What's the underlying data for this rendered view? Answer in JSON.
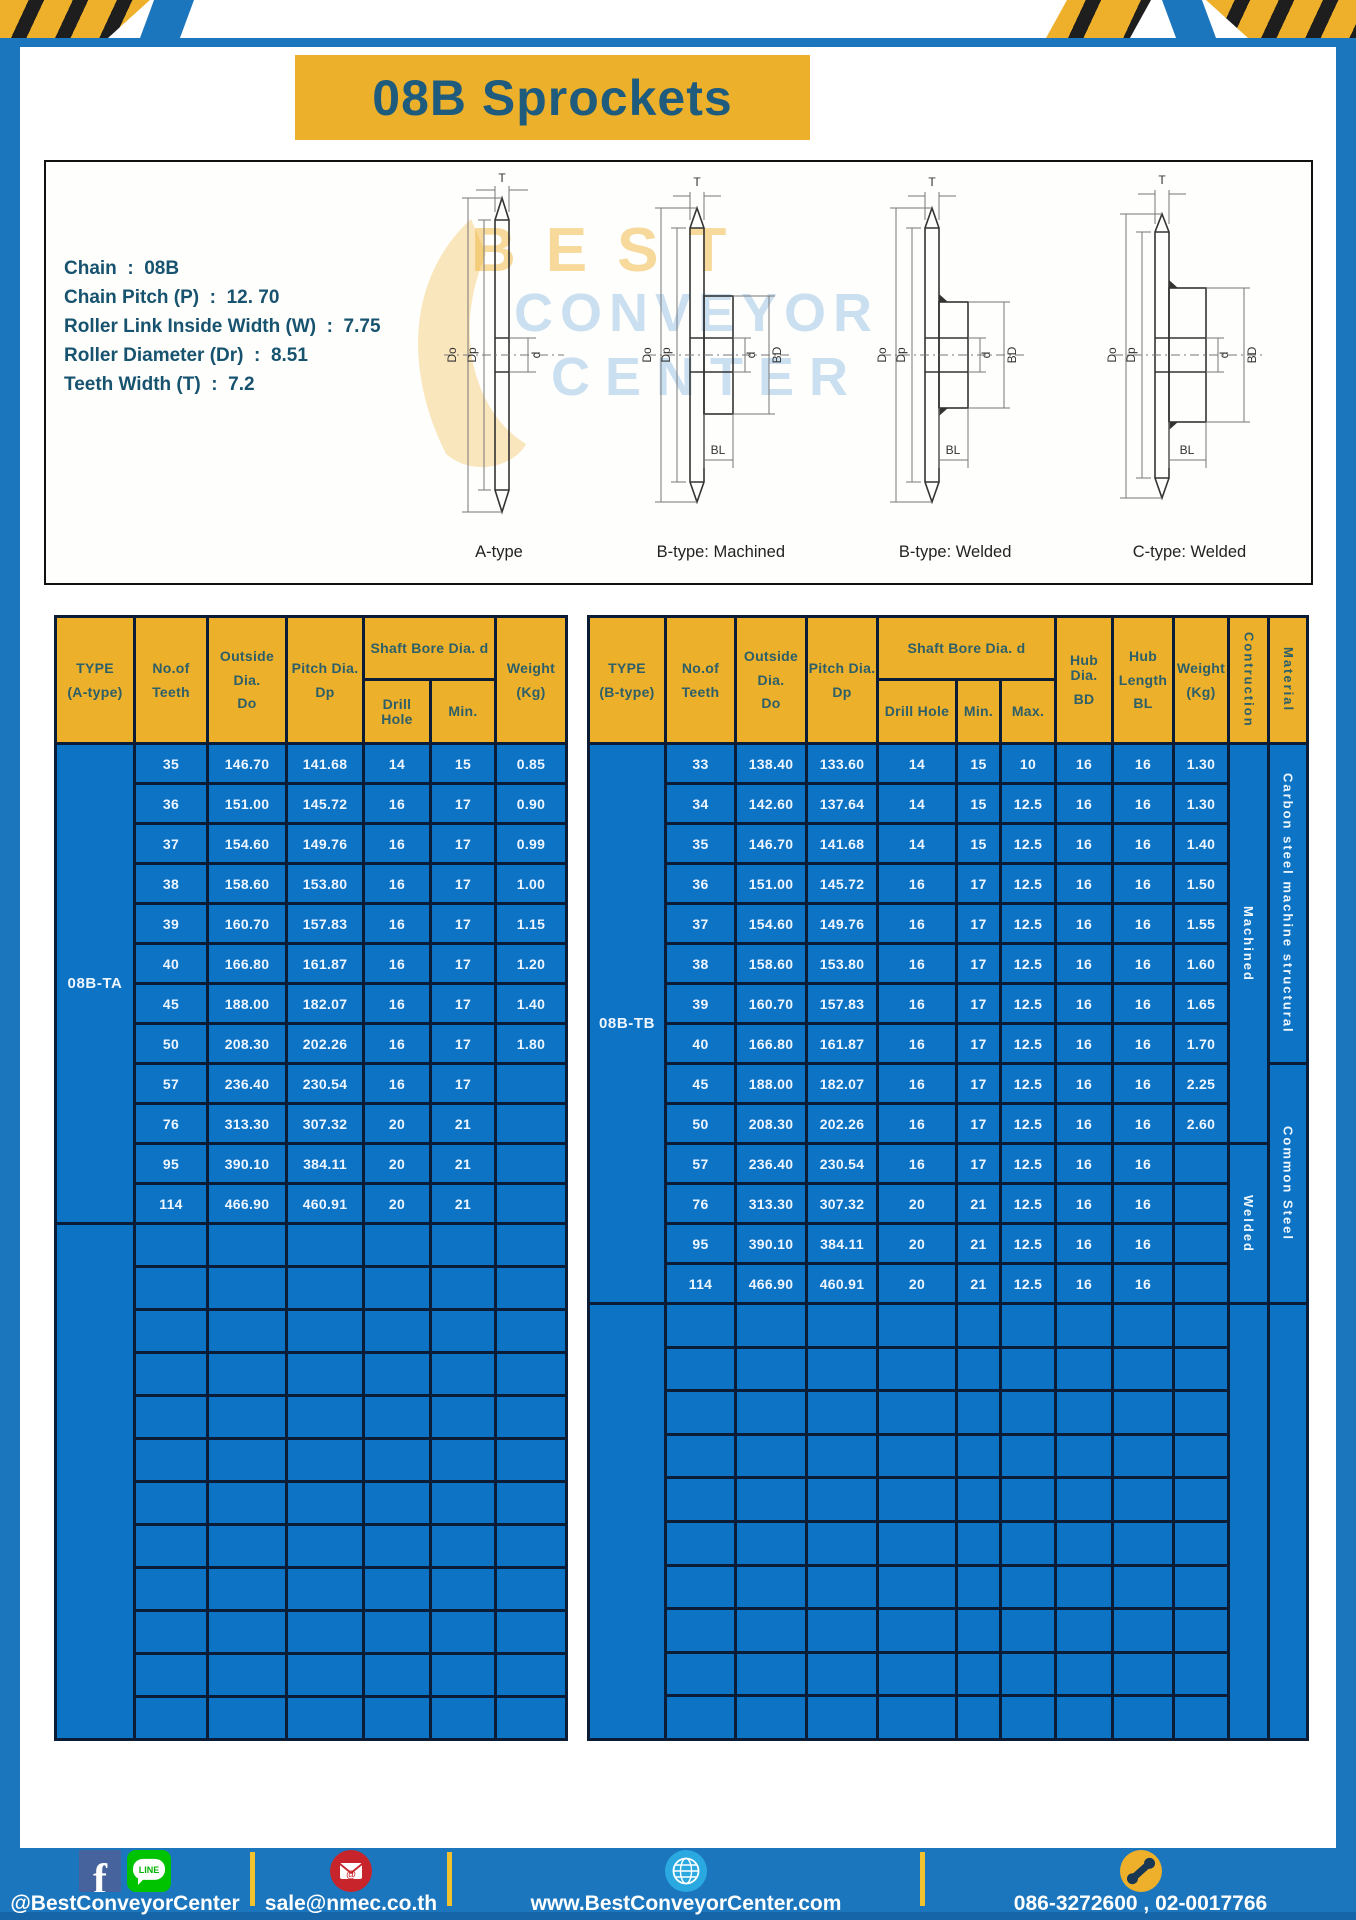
{
  "header": {
    "title": "08B Sprockets"
  },
  "specs": {
    "lines": [
      {
        "label": "Chain",
        "value": "08B"
      },
      {
        "label": "Chain Pitch (P)",
        "value": "12. 70"
      },
      {
        "label": "Roller Link Inside Width (W)",
        "value": "7.75"
      },
      {
        "label": "Roller Diameter (Dr)",
        "value": "8.51"
      },
      {
        "label": "Teeth Width (T)",
        "value": "7.2"
      }
    ]
  },
  "diagram": {
    "captions": [
      "A-type",
      "B-type: Machined",
      "B-type: Welded",
      "C-type: Welded"
    ],
    "dims": {
      "t": "T",
      "outer": "Do",
      "pitch": "Dp",
      "bore": "d",
      "hub": "BD",
      "hub_len": "BL"
    },
    "watermark": [
      "BEST",
      "CONVEYOR",
      "CENTER"
    ]
  },
  "table_a": {
    "headers": {
      "type1": "TYPE",
      "type2": "(A-type)",
      "teeth1": "No.of",
      "teeth2": "Teeth",
      "out1": "Outside",
      "out2": "Dia.",
      "out3": "Do",
      "pitch1": "Pitch Dia.",
      "pitch2": "Dp",
      "shaft": "Shaft Bore Dia. d",
      "drill": "Drill Hole",
      "min": "Min.",
      "w1": "Weight",
      "w2": "(Kg)"
    },
    "type_value": "08B-TA",
    "rows": [
      {
        "teeth": "35",
        "do": "146.70",
        "dp": "141.68",
        "drill": "14",
        "min": "15",
        "weight": "0.85"
      },
      {
        "teeth": "36",
        "do": "151.00",
        "dp": "145.72",
        "drill": "16",
        "min": "17",
        "weight": "0.90"
      },
      {
        "teeth": "37",
        "do": "154.60",
        "dp": "149.76",
        "drill": "16",
        "min": "17",
        "weight": "0.99"
      },
      {
        "teeth": "38",
        "do": "158.60",
        "dp": "153.80",
        "drill": "16",
        "min": "17",
        "weight": "1.00"
      },
      {
        "teeth": "39",
        "do": "160.70",
        "dp": "157.83",
        "drill": "16",
        "min": "17",
        "weight": "1.15"
      },
      {
        "teeth": "40",
        "do": "166.80",
        "dp": "161.87",
        "drill": "16",
        "min": "17",
        "weight": "1.20"
      },
      {
        "teeth": "45",
        "do": "188.00",
        "dp": "182.07",
        "drill": "16",
        "min": "17",
        "weight": "1.40"
      },
      {
        "teeth": "50",
        "do": "208.30",
        "dp": "202.26",
        "drill": "16",
        "min": "17",
        "weight": "1.80"
      },
      {
        "teeth": "57",
        "do": "236.40",
        "dp": "230.54",
        "drill": "16",
        "min": "17",
        "weight": ""
      },
      {
        "teeth": "76",
        "do": "313.30",
        "dp": "307.32",
        "drill": "20",
        "min": "21",
        "weight": ""
      },
      {
        "teeth": "95",
        "do": "390.10",
        "dp": "384.11",
        "drill": "20",
        "min": "21",
        "weight": ""
      },
      {
        "teeth": "114",
        "do": "466.90",
        "dp": "460.91",
        "drill": "20",
        "min": "21",
        "weight": ""
      }
    ]
  },
  "table_b": {
    "headers": {
      "type1": "TYPE",
      "type2": "(B-type)",
      "teeth1": "No.of",
      "teeth2": "Teeth",
      "out1": "Outside",
      "out2": "Dia.",
      "out3": "Do",
      "pitch1": "Pitch Dia.",
      "pitch2": "Dp",
      "shaft": "Shaft Bore Dia. d",
      "drill": "Drill Hole",
      "min": "Min.",
      "max": "Max.",
      "hubdia1": "Hub Dia.",
      "hubdia2": "BD",
      "hublen1": "Hub",
      "hublen2": "Length",
      "hublen3": "BL",
      "w1": "Weight",
      "w2": "(Kg)",
      "construction": "Contruction",
      "material": "Material"
    },
    "type_value": "08B-TB",
    "rows": [
      {
        "teeth": "33",
        "do": "138.40",
        "dp": "133.60",
        "drill": "14",
        "min": "15",
        "max": "10",
        "bd": "16",
        "bl": "16",
        "weight": "1.30"
      },
      {
        "teeth": "34",
        "do": "142.60",
        "dp": "137.64",
        "drill": "14",
        "min": "15",
        "max": "12.5",
        "bd": "16",
        "bl": "16",
        "weight": "1.30"
      },
      {
        "teeth": "35",
        "do": "146.70",
        "dp": "141.68",
        "drill": "14",
        "min": "15",
        "max": "12.5",
        "bd": "16",
        "bl": "16",
        "weight": "1.40"
      },
      {
        "teeth": "36",
        "do": "151.00",
        "dp": "145.72",
        "drill": "16",
        "min": "17",
        "max": "12.5",
        "bd": "16",
        "bl": "16",
        "weight": "1.50"
      },
      {
        "teeth": "37",
        "do": "154.60",
        "dp": "149.76",
        "drill": "16",
        "min": "17",
        "max": "12.5",
        "bd": "16",
        "bl": "16",
        "weight": "1.55"
      },
      {
        "teeth": "38",
        "do": "158.60",
        "dp": "153.80",
        "drill": "16",
        "min": "17",
        "max": "12.5",
        "bd": "16",
        "bl": "16",
        "weight": "1.60"
      },
      {
        "teeth": "39",
        "do": "160.70",
        "dp": "157.83",
        "drill": "16",
        "min": "17",
        "max": "12.5",
        "bd": "16",
        "bl": "16",
        "weight": "1.65"
      },
      {
        "teeth": "40",
        "do": "166.80",
        "dp": "161.87",
        "drill": "16",
        "min": "17",
        "max": "12.5",
        "bd": "16",
        "bl": "16",
        "weight": "1.70"
      },
      {
        "teeth": "45",
        "do": "188.00",
        "dp": "182.07",
        "drill": "16",
        "min": "17",
        "max": "12.5",
        "bd": "16",
        "bl": "16",
        "weight": "2.25"
      },
      {
        "teeth": "50",
        "do": "208.30",
        "dp": "202.26",
        "drill": "16",
        "min": "17",
        "max": "12.5",
        "bd": "16",
        "bl": "16",
        "weight": "2.60"
      },
      {
        "teeth": "57",
        "do": "236.40",
        "dp": "230.54",
        "drill": "16",
        "min": "17",
        "max": "12.5",
        "bd": "16",
        "bl": "16",
        "weight": ""
      },
      {
        "teeth": "76",
        "do": "313.30",
        "dp": "307.32",
        "drill": "20",
        "min": "21",
        "max": "12.5",
        "bd": "16",
        "bl": "16",
        "weight": ""
      },
      {
        "teeth": "95",
        "do": "390.10",
        "dp": "384.11",
        "drill": "20",
        "min": "21",
        "max": "12.5",
        "bd": "16",
        "bl": "16",
        "weight": ""
      },
      {
        "teeth": "114",
        "do": "466.90",
        "dp": "460.91",
        "drill": "20",
        "min": "21",
        "max": "12.5",
        "bd": "16",
        "bl": "16",
        "weight": ""
      }
    ],
    "construction_groups": [
      {
        "label": "Machined"
      },
      {
        "label": "Welded"
      }
    ],
    "material_groups": [
      {
        "label": "Carbon steel  machine structural"
      },
      {
        "label": "Common Steel"
      }
    ]
  },
  "footer": {
    "items": [
      {
        "text": "@BestConveyorCenter"
      },
      {
        "text": "sale@nmec.co.th"
      },
      {
        "text": "www.BestConveyorCenter.com"
      },
      {
        "text": "086-3272600 , 02-0017766"
      }
    ]
  }
}
